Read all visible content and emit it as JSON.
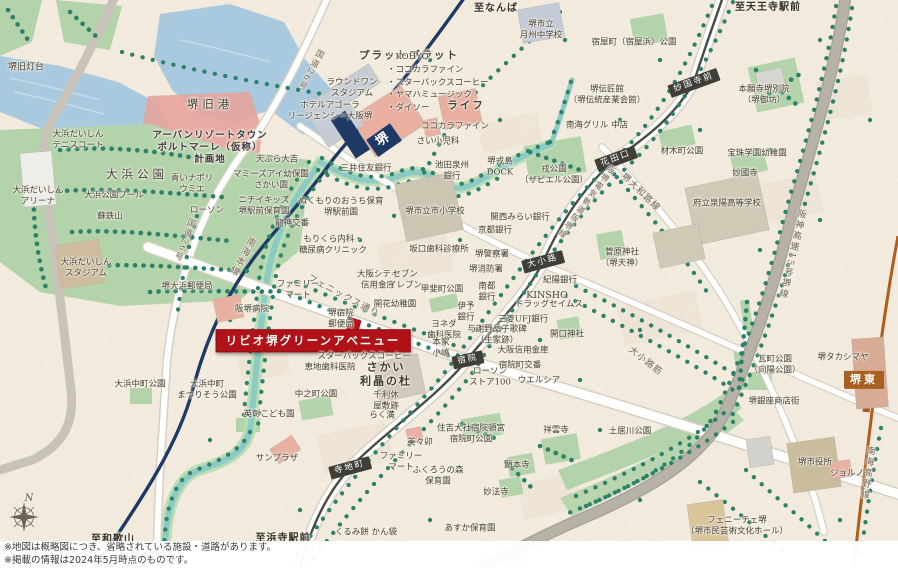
{
  "notes": {
    "line1": "※地図は概略図につき、省略されている施設・道路があります。",
    "line2": "※掲載の情報は2024年5月時点のものです。"
  },
  "colors": {
    "land": "#f2eadd",
    "water": "#a9cade",
    "park": "#b3d3aa",
    "tree": "#2c8268",
    "nankai_main_line": "#1d3965",
    "hankai_tram_line": "#4b4b42",
    "nankai_koya_line": "#b05c1b",
    "expressway": "#b7b2a8",
    "property_red": "#b11218"
  },
  "labels": [
    {
      "t": "至なんば",
      "x": 496,
      "y": 9,
      "c": "dir",
      "n": "to-namba-label"
    },
    {
      "t": "至天王寺駅前",
      "x": 768,
      "y": 8,
      "c": "dir",
      "n": "to-tennoji-label"
    },
    {
      "t": "至和歌山",
      "x": 113,
      "y": 540,
      "c": "dir",
      "n": "to-wakayama-label"
    },
    {
      "t": "至浜寺駅前",
      "x": 283,
      "y": 539,
      "c": "dir",
      "n": "to-hamadera-label"
    },
    {
      "t": "堺",
      "x": 384,
      "y": 140,
      "c": "st stnavy",
      "r": -35,
      "s": 13,
      "n": "station-sakai"
    },
    {
      "t": "堺東",
      "x": 864,
      "y": 380,
      "c": "st stbrown",
      "s": 11,
      "n": "station-sakaihigashi"
    },
    {
      "t": "妙国寺前",
      "x": 694,
      "y": 83,
      "c": "st",
      "r": -20,
      "n": "station-myokokujimae"
    },
    {
      "t": "花田口",
      "x": 616,
      "y": 159,
      "c": "st",
      "r": -20,
      "n": "station-hanataguchi"
    },
    {
      "t": "大小路",
      "x": 543,
      "y": 262,
      "c": "st",
      "r": -15,
      "n": "station-oshoji"
    },
    {
      "t": "宿院",
      "x": 468,
      "y": 360,
      "c": "st",
      "r": -12,
      "n": "station-shukuin"
    },
    {
      "t": "寺地町",
      "x": 350,
      "y": 468,
      "c": "st",
      "r": -15,
      "n": "station-terajicho"
    },
    {
      "t": "南海本線",
      "x": 241,
      "y": 256,
      "c": "road vert",
      "r": 30,
      "s": 9,
      "n": "nankai-main-line-label"
    },
    {
      "t": "阪堺電気軌道阪堺線",
      "x": 586,
      "y": 202,
      "c": "road vert",
      "r": 37,
      "s": 8,
      "n": "hankai-line-label"
    },
    {
      "t": "阪神高速15号堺線",
      "x": 791,
      "y": 254,
      "c": "road vert",
      "r": 13,
      "s": 9,
      "n": "expressway-label"
    },
    {
      "t": "南海高野線",
      "x": 866,
      "y": 473,
      "c": "road vert",
      "r": 8,
      "s": 9,
      "n": "koya-line-label"
    },
    {
      "t": "国道26号",
      "x": 310,
      "y": 70,
      "c": "road vert",
      "r": 28,
      "n": "route26-label"
    },
    {
      "t": "国道26号",
      "x": 184,
      "y": 240,
      "c": "road vert",
      "r": 20,
      "n": "route26-label"
    },
    {
      "t": "堺大和路線",
      "x": 640,
      "y": 193,
      "c": "road",
      "r": 44,
      "s": 9,
      "n": "yamatoji-road-label"
    },
    {
      "t": "大小路筋",
      "x": 645,
      "y": 362,
      "c": "road",
      "r": 38,
      "s": 9,
      "n": "oshoji-suji-label"
    },
    {
      "t": "フェニックス通り",
      "x": 343,
      "y": 297,
      "c": "road",
      "r": 28,
      "s": 9,
      "n": "phoenix-street-label"
    },
    {
      "t": "リビオ堺グリーンアベニュー",
      "x": 313,
      "y": 341,
      "c": "property",
      "s": 11.5,
      "n": "property-label"
    },
    {
      "t": "N",
      "x": 29,
      "y": 499,
      "c": "compassN",
      "n": "compass-north-label"
    },
    {
      "t": "堺旧灯台",
      "x": 26,
      "y": 68,
      "s": 9,
      "n": "poi-label"
    },
    {
      "t": "堺旧港",
      "x": 210,
      "y": 104,
      "c": "big",
      "n": "poi-label"
    },
    {
      "t": "アーバンリゾートタウン\nポルトマーレ（仮称）\n計画地",
      "x": 210,
      "y": 148,
      "c": "plan",
      "n": "development-site-label"
    },
    {
      "t": "大浜公園",
      "x": 137,
      "y": 174,
      "c": "big",
      "n": "park-label"
    },
    {
      "t": "大浜だいしん\nアリーナ",
      "x": 38,
      "y": 196,
      "n": "poi-label"
    },
    {
      "t": "大浜公園プール",
      "x": 114,
      "y": 196,
      "n": "poi-label"
    },
    {
      "t": "蘇鉄山",
      "x": 110,
      "y": 217,
      "n": "poi-label"
    },
    {
      "t": "大浜だいしん\nテニスコート",
      "x": 78,
      "y": 140,
      "n": "poi-label"
    },
    {
      "t": "大浜だいしん\nスタジアム",
      "x": 86,
      "y": 268,
      "n": "poi-label"
    },
    {
      "t": "天ぷら大吉",
      "x": 277,
      "y": 160,
      "n": "poi-label"
    },
    {
      "t": "マミーズアイ幼保園\nさかい園",
      "x": 271,
      "y": 180,
      "n": "poi-label"
    },
    {
      "t": "ニチイキッズ\n堺駅前保育園",
      "x": 264,
      "y": 206,
      "n": "poi-label"
    },
    {
      "t": "ローソン",
      "x": 207,
      "y": 211,
      "n": "poi-label"
    },
    {
      "t": "青いナポリ\nウミエ",
      "x": 192,
      "y": 184,
      "n": "poi-label"
    },
    {
      "t": "堺大浜郵便局",
      "x": 187,
      "y": 287,
      "n": "poi-label"
    },
    {
      "t": "ホテルアゴーラ\nリージェンシー大阪堺",
      "x": 330,
      "y": 111,
      "n": "poi-label"
    },
    {
      "t": "ラウンドワン\nスタジアム",
      "x": 352,
      "y": 88,
      "n": "poi-label"
    },
    {
      "t": "プラットプラット",
      "x": 409,
      "y": 56,
      "c": "bold",
      "s": 10.5,
      "n": "poi-label"
    },
    {
      "t": "・KOHYO\n・ココカラファイン\n・スターバックスコーヒー\n・ヤマハミュージック\n・ダイソー",
      "x": 387,
      "y": 83,
      "c": "list",
      "a": "l",
      "n": "tenant-list-label"
    },
    {
      "t": "堺市立\n月州中学校",
      "x": 541,
      "y": 30,
      "n": "poi-label"
    },
    {
      "t": "ライフ",
      "x": 466,
      "y": 106,
      "c": "bold",
      "s": 10.5,
      "n": "poi-label"
    },
    {
      "t": "ココカラファイン",
      "x": 455,
      "y": 127,
      "n": "poi-label"
    },
    {
      "t": "さい小児科",
      "x": 438,
      "y": 142,
      "n": "poi-label"
    },
    {
      "t": "三井住友銀行",
      "x": 366,
      "y": 169,
      "n": "poi-label"
    },
    {
      "t": "池田泉州\n銀行",
      "x": 452,
      "y": 171,
      "n": "poi-label"
    },
    {
      "t": "堺戎島\nDOCK",
      "x": 500,
      "y": 167,
      "n": "poi-label"
    },
    {
      "t": "戎公園\n（ザビエル公園）",
      "x": 554,
      "y": 175,
      "n": "park-label"
    },
    {
      "t": "ぬくもりのおうち保育\n堺駅前園",
      "x": 341,
      "y": 207,
      "n": "poi-label"
    },
    {
      "t": "堺市立市小学校",
      "x": 435,
      "y": 212,
      "n": "poi-label"
    },
    {
      "t": "関西みらい銀行",
      "x": 520,
      "y": 218,
      "n": "poi-label"
    },
    {
      "t": "京都銀行",
      "x": 495,
      "y": 231,
      "n": "poi-label"
    },
    {
      "t": "龍神交番",
      "x": 292,
      "y": 224,
      "n": "poi-label"
    },
    {
      "t": "もりくら内科・\n糖尿病クリニック",
      "x": 333,
      "y": 245,
      "n": "poi-label"
    },
    {
      "t": "坂口歯科診療所",
      "x": 439,
      "y": 250,
      "n": "poi-label"
    },
    {
      "t": "堺警察署",
      "x": 492,
      "y": 255,
      "n": "poi-label"
    },
    {
      "t": "堺消防署",
      "x": 486,
      "y": 270,
      "n": "poi-label"
    },
    {
      "t": "大阪シティ\n信用金庫",
      "x": 378,
      "y": 280,
      "n": "poi-label"
    },
    {
      "t": "セブン\nイレブン",
      "x": 405,
      "y": 280,
      "n": "poi-label"
    },
    {
      "t": "紀陽銀行",
      "x": 560,
      "y": 281,
      "n": "poi-label"
    },
    {
      "t": "ファミリー\nマート",
      "x": 298,
      "y": 290,
      "n": "poi-label"
    },
    {
      "t": "甲斐町公園",
      "x": 442,
      "y": 290,
      "n": "park-label"
    },
    {
      "t": "南都\n銀行",
      "x": 487,
      "y": 292,
      "n": "poi-label"
    },
    {
      "t": "伊予\n銀行",
      "x": 466,
      "y": 312,
      "n": "poi-label"
    },
    {
      "t": "KINSHO",
      "x": 547,
      "y": 296,
      "s": 9.5,
      "n": "poi-label"
    },
    {
      "t": "ドラッグセイムス",
      "x": 549,
      "y": 305,
      "n": "poi-label"
    },
    {
      "t": "三菱UFJ銀行",
      "x": 523,
      "y": 320,
      "n": "poi-label"
    },
    {
      "t": "開口神社",
      "x": 567,
      "y": 335,
      "n": "poi-label"
    },
    {
      "t": "開花幼稚園",
      "x": 395,
      "y": 305,
      "n": "poi-label"
    },
    {
      "t": "堺宿院\n郵便局",
      "x": 341,
      "y": 319,
      "n": "poi-label"
    },
    {
      "t": "ヨネダ\n歯科医院",
      "x": 444,
      "y": 330,
      "n": "poi-label"
    },
    {
      "t": "与謝野晶子歌碑\n（生家跡）",
      "x": 497,
      "y": 335,
      "n": "poi-label"
    },
    {
      "t": "本家\n小嶋",
      "x": 441,
      "y": 348,
      "n": "poi-label"
    },
    {
      "t": "スターバックスコーヒー",
      "x": 364,
      "y": 357,
      "n": "poi-label"
    },
    {
      "t": "恵地歯科医院",
      "x": 330,
      "y": 368,
      "n": "poi-label"
    },
    {
      "t": "さかい\n利晶の杜",
      "x": 386,
      "y": 374,
      "c": "bold",
      "s": 11,
      "n": "poi-label"
    },
    {
      "t": "中之町公園",
      "x": 316,
      "y": 395,
      "n": "park-label"
    },
    {
      "t": "千利休\n屋敷跡",
      "x": 386,
      "y": 401,
      "n": "poi-label"
    },
    {
      "t": "らく満",
      "x": 382,
      "y": 416,
      "n": "poi-label"
    },
    {
      "t": "ローソン\nストア100",
      "x": 490,
      "y": 377,
      "n": "poi-label"
    },
    {
      "t": "大阪信用金庫",
      "x": 523,
      "y": 351,
      "n": "poi-label"
    },
    {
      "t": "宿院町交番",
      "x": 520,
      "y": 366,
      "n": "poi-label"
    },
    {
      "t": "ウエルシア",
      "x": 539,
      "y": 381,
      "n": "poi-label"
    },
    {
      "t": "住吉大社宿院頓宮\n宿院町公園",
      "x": 471,
      "y": 434,
      "n": "poi-label"
    },
    {
      "t": "美々卯",
      "x": 420,
      "y": 443,
      "n": "poi-label"
    },
    {
      "t": "ファミリー\nマート",
      "x": 401,
      "y": 462,
      "n": "poi-label"
    },
    {
      "t": "ふくろうの森\n保育園",
      "x": 438,
      "y": 476,
      "n": "poi-label"
    },
    {
      "t": "くるみ餅 かん袋",
      "x": 366,
      "y": 533,
      "n": "poi-label"
    },
    {
      "t": "あすか保育園",
      "x": 470,
      "y": 529,
      "n": "poi-label"
    },
    {
      "t": "祥雲寺",
      "x": 556,
      "y": 431,
      "n": "poi-label"
    },
    {
      "t": "顕本寺",
      "x": 517,
      "y": 466,
      "n": "poi-label"
    },
    {
      "t": "妙法寺",
      "x": 496,
      "y": 493,
      "n": "poi-label"
    },
    {
      "t": "英彰こども園",
      "x": 269,
      "y": 415,
      "n": "poi-label"
    },
    {
      "t": "阪堺病院",
      "x": 252,
      "y": 310,
      "n": "poi-label"
    },
    {
      "t": "大浜中町公園",
      "x": 140,
      "y": 385,
      "n": "park-label"
    },
    {
      "t": "大浜中町\nまつりそう公園",
      "x": 207,
      "y": 390,
      "n": "park-label"
    },
    {
      "t": "材木町公園",
      "x": 682,
      "y": 152,
      "n": "park-label"
    },
    {
      "t": "宝珠学園幼稚園",
      "x": 757,
      "y": 154,
      "n": "poi-label"
    },
    {
      "t": "妙國寺",
      "x": 745,
      "y": 174,
      "n": "poi-label"
    },
    {
      "t": "本願寺堺別院\n（堺御坊）",
      "x": 764,
      "y": 95,
      "n": "poi-label"
    },
    {
      "t": "堺伝匠館\n（堺伝統産業会館）",
      "x": 607,
      "y": 95,
      "n": "poi-label"
    },
    {
      "t": "南海グリル 中店",
      "x": 597,
      "y": 126,
      "n": "poi-label"
    },
    {
      "t": "宿屋町（宿屋浜）公園",
      "x": 634,
      "y": 43,
      "n": "park-label"
    },
    {
      "t": "府立泉陽高等学校",
      "x": 727,
      "y": 204,
      "n": "poi-label"
    },
    {
      "t": "菅原神社\n（堺天神）",
      "x": 622,
      "y": 258,
      "n": "poi-label"
    },
    {
      "t": "瓦町公園\n（向陽公園）",
      "x": 775,
      "y": 365,
      "n": "park-label"
    },
    {
      "t": "堺タカシマヤ",
      "x": 843,
      "y": 358,
      "n": "poi-label"
    },
    {
      "t": "堺銀座商店街",
      "x": 774,
      "y": 402,
      "n": "poi-label"
    },
    {
      "t": "土居川公園",
      "x": 630,
      "y": 432,
      "n": "park-label"
    },
    {
      "t": "堺市役所",
      "x": 815,
      "y": 463,
      "n": "poi-label"
    },
    {
      "t": "ジョルノ",
      "x": 847,
      "y": 474,
      "n": "poi-label"
    },
    {
      "t": "フェニーチェ堺\n（堺市民芸術文化ホール）",
      "x": 737,
      "y": 526,
      "n": "poi-label"
    },
    {
      "t": "サンプラザ",
      "x": 277,
      "y": 459,
      "n": "poi-label"
    }
  ]
}
